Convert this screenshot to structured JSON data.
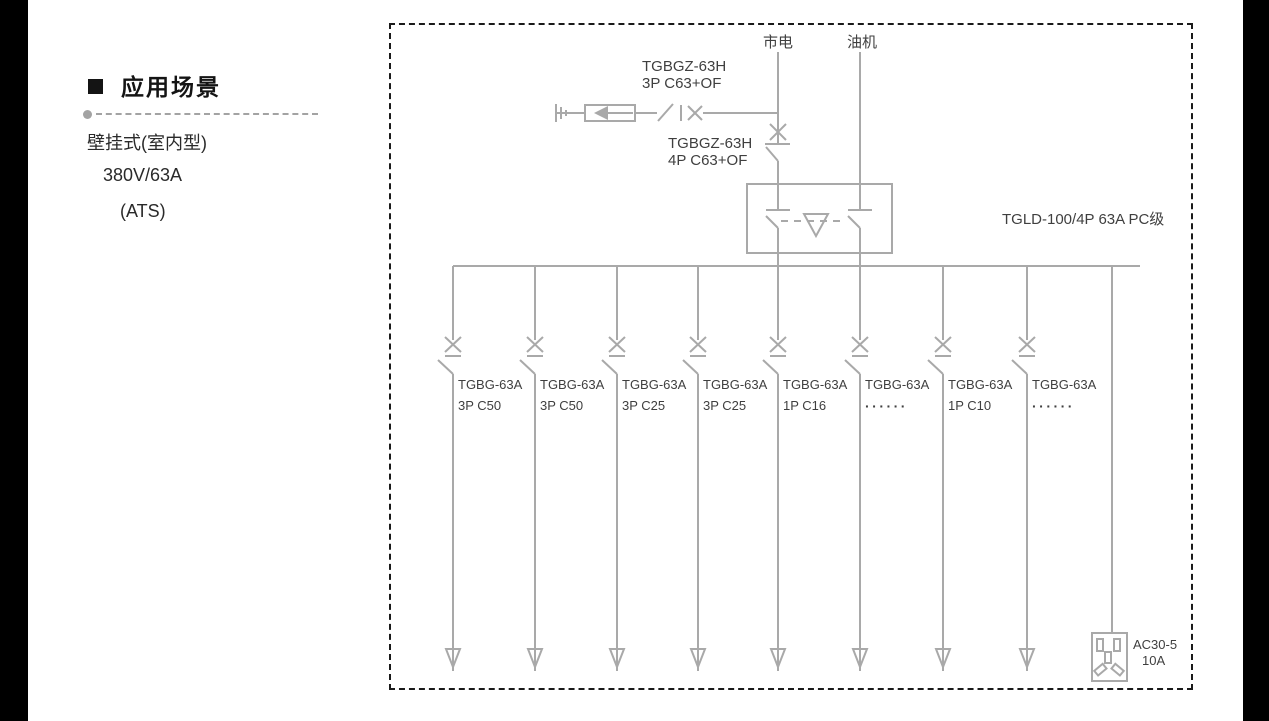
{
  "sidebar": {
    "heading": "应用场景",
    "lines": [
      "壁挂式(室内型)",
      "380V/63A",
      "(ATS)"
    ]
  },
  "diagram": {
    "sources": {
      "mains": "市电",
      "generator": "油机"
    },
    "spd_breaker": {
      "model": "TGBGZ-63H",
      "spec": "3P C63+OF"
    },
    "main_breaker": {
      "model": "TGBGZ-63H",
      "spec": "4P C63+OF"
    },
    "ats": {
      "label": "TGLD-100/4P 63A PC级"
    },
    "branches": [
      {
        "model": "TGBG-63A",
        "spec": "3P C50"
      },
      {
        "model": "TGBG-63A",
        "spec": "3P C50"
      },
      {
        "model": "TGBG-63A",
        "spec": "3P C25"
      },
      {
        "model": "TGBG-63A",
        "spec": "3P C25"
      },
      {
        "model": "TGBG-63A",
        "spec": "1P C16"
      },
      {
        "model": "TGBG-63A",
        "spec": "······"
      },
      {
        "model": "TGBG-63A",
        "spec": "1P C10"
      },
      {
        "model": "TGBG-63A",
        "spec": "······"
      }
    ],
    "socket": {
      "model": "AC30-5",
      "rating": "10A"
    }
  },
  "colors": {
    "line": "#a9a9a9",
    "text": "#3f3f3f",
    "border": "#1a1a1a",
    "heading": "#141414"
  }
}
